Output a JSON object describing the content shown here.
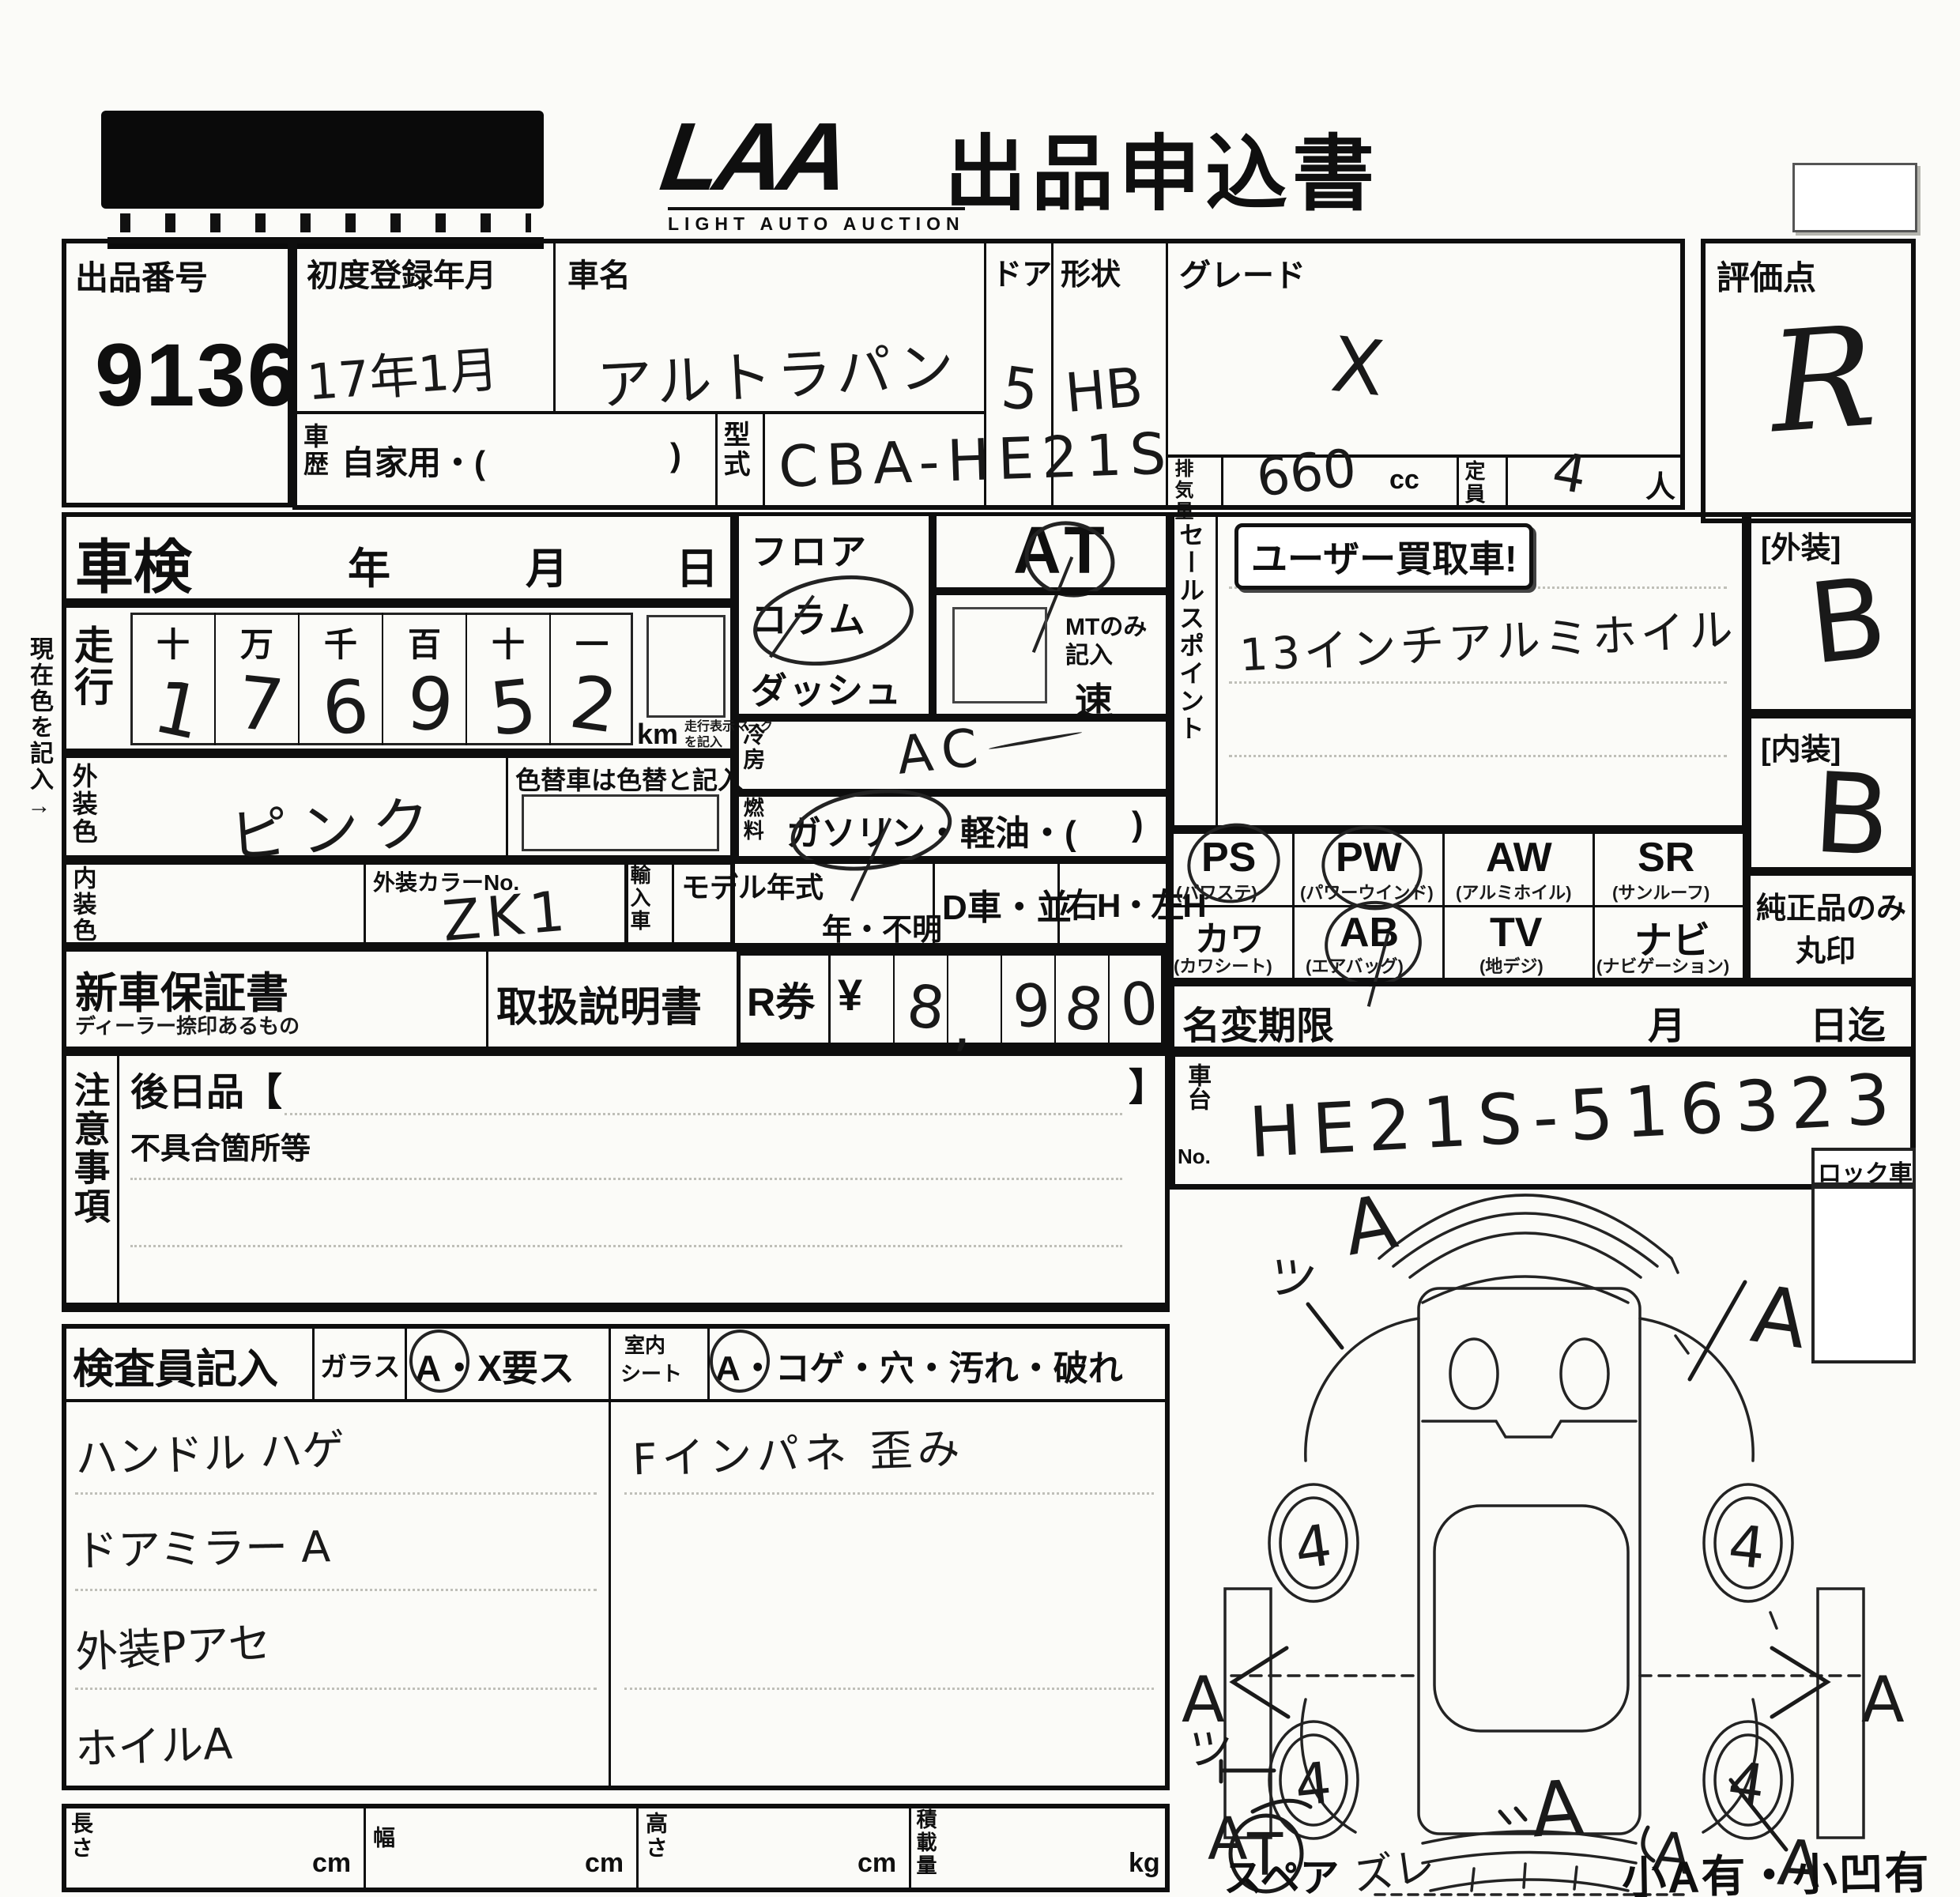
{
  "header": {
    "logo": "LAA",
    "logo_sub": "LIGHT AUTO AUCTION",
    "title": "出品申込書"
  },
  "top": {
    "auction_no_label": "出品番号",
    "auction_no": "9136",
    "first_reg_label": "初度登録年月",
    "first_reg_value": "17年1月",
    "car_name_label": "車名",
    "car_name_value": "アルトラパン",
    "door_label": "ドア",
    "door_value": "5",
    "shape_label": "形状",
    "shape_value": "HB",
    "grade_label": "グレード",
    "grade_value": "X",
    "history_label": "車歴",
    "history_value": "自家用・(",
    "history_close": ")",
    "model_code_label": "型式",
    "model_code_value": "CBA-HE21S",
    "disp_label": "排気量",
    "disp_value": "660",
    "disp_unit": "cc",
    "cap_label": "定員",
    "cap_value": "4",
    "cap_unit": "人",
    "score_label": "評価点",
    "score_value": "R"
  },
  "shaken": {
    "label": "車検",
    "year": "年",
    "month": "月",
    "day": "日"
  },
  "mileage": {
    "label": "走行",
    "margin_note": "現在色を記入→",
    "cols": [
      "十",
      "万",
      "千",
      "百",
      "十",
      "一"
    ],
    "digits": [
      "1",
      "7",
      "6",
      "9",
      "5",
      "2"
    ],
    "unit": "km",
    "note1": "走行表示マーク",
    "note2": "を記入"
  },
  "colors": {
    "ext_label": "外装色",
    "ext_value": "ピンク",
    "repaint_note": "色替車は色替と記入",
    "int_label": "内装色",
    "colorno_label": "外装カラーNo.",
    "colorno_value": "ZK1"
  },
  "trans": {
    "floor": "フロア",
    "column": "コラム",
    "dash": "ダッシュ",
    "at": "AT",
    "mt1": "MTのみ",
    "mt2": "記入",
    "speed": "速",
    "cool_label": "冷房",
    "cool_value": "AC",
    "fuel_label": "燃料",
    "fuel_text": "ガソリン・軽油・(",
    "fuel_close": ")"
  },
  "imp": {
    "import_label": "輸入車",
    "my_label": "モデル年式",
    "my_opts": "年・不明",
    "dcar": "D車・並",
    "handle": "右H・左H"
  },
  "sales": {
    "label": "セールスポイント",
    "stamp": "ユーザー買取車!",
    "note": "13インチアルミホイル"
  },
  "ratings": {
    "ext_label": "[外装]",
    "ext": "B",
    "int_label": "[内装]",
    "int": "B"
  },
  "opts": {
    "r1": [
      {
        "c": "PS",
        "n": "(パワステ)"
      },
      {
        "c": "PW",
        "n": "(パワーウインド)"
      },
      {
        "c": "AW",
        "n": "(アルミホイル)"
      },
      {
        "c": "SR",
        "n": "(サンルーフ)"
      }
    ],
    "r2": [
      {
        "c": "カワ",
        "n": "(カワシート)"
      },
      {
        "c": "AB",
        "n": "(エアバッグ)"
      },
      {
        "c": "TV",
        "n": "(地デジ)"
      },
      {
        "c": "ナビ",
        "n": "(ナビゲーション)"
      }
    ],
    "genuine1": "純正品のみ",
    "genuine2": "丸印"
  },
  "docs": {
    "warranty": "新車保証書",
    "warranty_sub": "ディーラー捺印あるもの",
    "manual": "取扱説明書",
    "rticket": "R券",
    "yen": "¥",
    "digits": [
      "",
      "8",
      "9",
      "8",
      "0"
    ],
    "comma": ","
  },
  "namechange": {
    "label": "名変期限",
    "month": "月",
    "until": "日迄"
  },
  "chassis": {
    "label1": "車台",
    "label2": "No.",
    "value": "HE21S-516323"
  },
  "notes": {
    "label": "注意事項",
    "later": "後日品【",
    "later_close": "】",
    "defects": "不具合箇所等"
  },
  "inspector": {
    "label": "検査員記入",
    "glass": "ガラス",
    "glass_opts": "A・X要ス",
    "seat1": "室内",
    "seat2": "シート",
    "seat_opts": "A・コゲ・穴・汚れ・破れ",
    "notes": [
      "ハンドル ハゲ",
      "ドアミラー A",
      "外装Pアセ",
      "ホイルA"
    ],
    "panel": "Fインパネ 歪み"
  },
  "diagram": {
    "lock": "ロック車",
    "spare": "スペア",
    "bottom_note": "小A有・小凹有",
    "wheels": [
      "4",
      "4",
      "4",
      "4"
    ],
    "marks": {
      "top_a": "A",
      "fl_w": "ツ",
      "fr_a": "A",
      "ml_a": "A",
      "mr_a": "A",
      "rl_w": "ツ",
      "rl_a": "A",
      "spare_t": "T",
      "rw_a": "A",
      "zure": "ズレ",
      "br_a": "A",
      "rr_a": "A"
    }
  },
  "dims": {
    "len": "長さ",
    "wid": "幅",
    "hei": "高さ",
    "load": "積載量",
    "cm": "cm",
    "kg": "kg"
  }
}
